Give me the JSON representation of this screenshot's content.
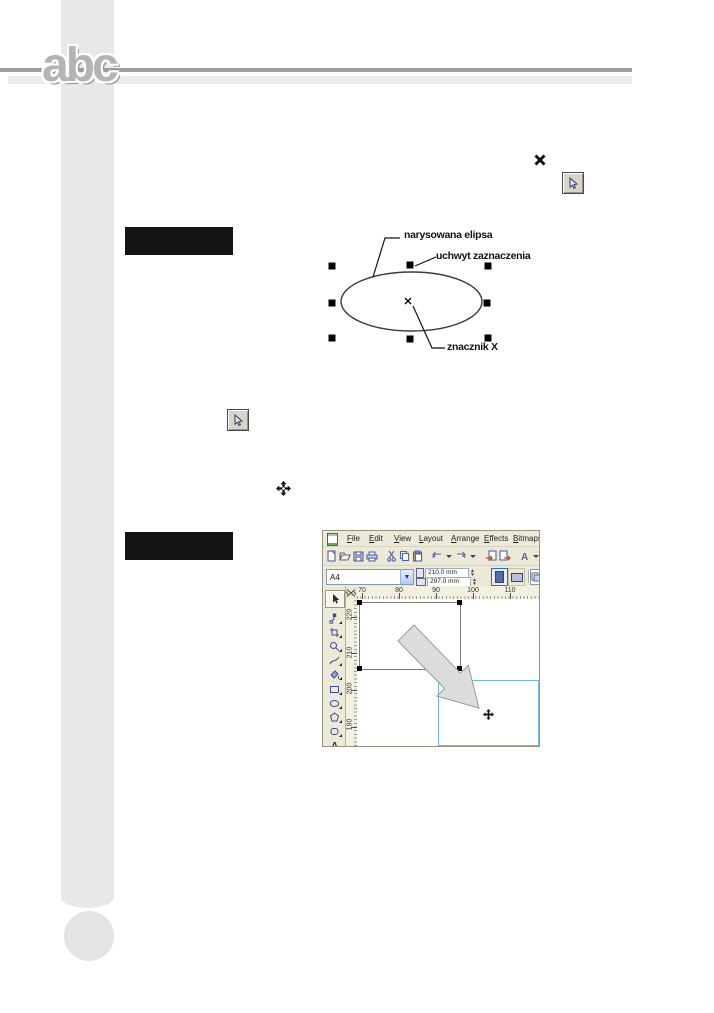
{
  "page": {
    "logo": "abc"
  },
  "figure1": {
    "labels": {
      "ellipse": "narysowana elipsa",
      "handle": "uchwyt zaznaczenia",
      "marker_x": "znacznik X"
    }
  },
  "coreldraw": {
    "menus": [
      "File",
      "Edit",
      "View",
      "Layout",
      "Arrange",
      "Effects",
      "Bitmaps"
    ],
    "toolbar_icons": [
      "new",
      "open",
      "save",
      "print",
      "cut",
      "copy",
      "paste",
      "undo",
      "redo",
      "import",
      "export",
      "application-launcher",
      "zoom-levels"
    ],
    "property_bar": {
      "paper_size": "A4",
      "paper_width": "210.0 mm",
      "paper_height": "297.0 mm",
      "orientation": [
        "portrait",
        "landscape"
      ]
    },
    "ruler_h": [
      "70",
      "80",
      "90",
      "100",
      "110"
    ],
    "ruler_v": [
      "220",
      "210",
      "200",
      "190"
    ],
    "toolbox_icons": [
      "pick",
      "shape",
      "crop",
      "zoom",
      "freehand",
      "smart-fill",
      "rectangle",
      "ellipse",
      "polygon",
      "basic-shapes",
      "text"
    ]
  },
  "colors": {
    "chrome_tan": "#ece9d8",
    "ruler_bg": "#f4f0e0",
    "preview_rect_blue": "#70bce9",
    "sidebar_gray": "#e8e8e8",
    "rule_dark": "#9c9c9c",
    "rule_light": "#ececec",
    "caption_bar": "#141414"
  }
}
